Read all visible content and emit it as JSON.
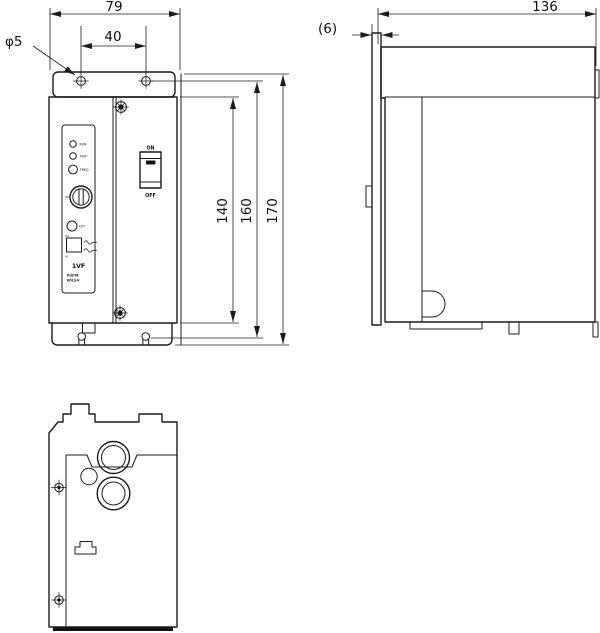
{
  "drawing_type": "dimensioned outline drawing, 3 views (front, side, bottom)",
  "colors": {
    "line": "#1c1c1c",
    "background": "#ffffff",
    "switch_fill": "#111111"
  },
  "dims": {
    "front": {
      "width": "79",
      "hole_pitch": "40",
      "hole_diameter": "φ5",
      "body_height": "140",
      "mounting_height": "160",
      "overall_height": "170"
    },
    "side": {
      "depth": "136",
      "plate_offset": "(6)"
    }
  },
  "panel": {
    "led_labels": [
      "RUN",
      "TRIP",
      "FREQ"
    ],
    "pot_label": "EXT",
    "slide_switch_top_label": "EA",
    "slide_switch_bottom_label": "M",
    "model": "1VF",
    "model_sub_line1": "KUJ/TR",
    "model_sub_line2": "KOLS-V"
  },
  "power_switch": {
    "on": "ON",
    "off": "OFF"
  },
  "icons": {
    "sine_wave_icon": "∿",
    "screw_head_icon": "⊕",
    "mounting_hole_icon": "⌖",
    "rotary_knob_icon": "⦶"
  }
}
